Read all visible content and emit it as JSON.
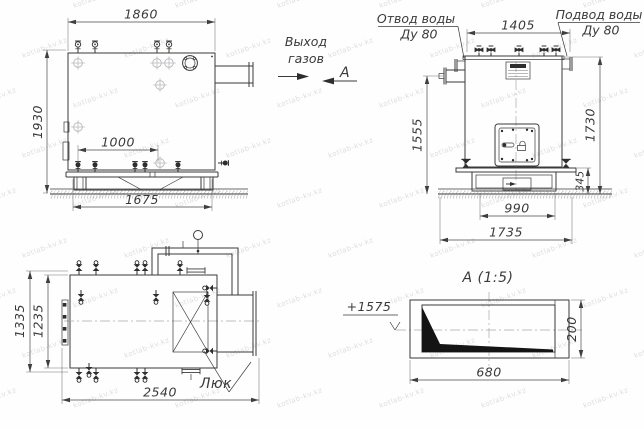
{
  "watermark": "kotlab-kv.kz",
  "labels": {
    "gas_outlet_line1": "Выход",
    "gas_outlet_line2": "газов",
    "section_arrow": "А",
    "water_outlet_line1": "Отвод воды",
    "water_outlet_line2": "Ду 80",
    "water_inlet_line1": "Подвод воды",
    "water_inlet_line2": "Ду 80",
    "hatch": "Люк",
    "section_title": "А (1:5)",
    "elevation": "+1575"
  },
  "dimensions": {
    "side_view": {
      "overall_width": "1860",
      "overall_height": "1930",
      "valve_spacing": "1000",
      "base_length": "1675"
    },
    "front_view": {
      "top_width": "1405",
      "outlet_height": "1555",
      "overall_height": "1730",
      "base_height": "345",
      "base_width": "990",
      "overall_width": "1735"
    },
    "plan_view": {
      "overall_depth": "1335",
      "body_depth": "1235",
      "overall_length": "2540"
    },
    "section_view": {
      "duct_width": "680",
      "duct_height": "200"
    }
  }
}
